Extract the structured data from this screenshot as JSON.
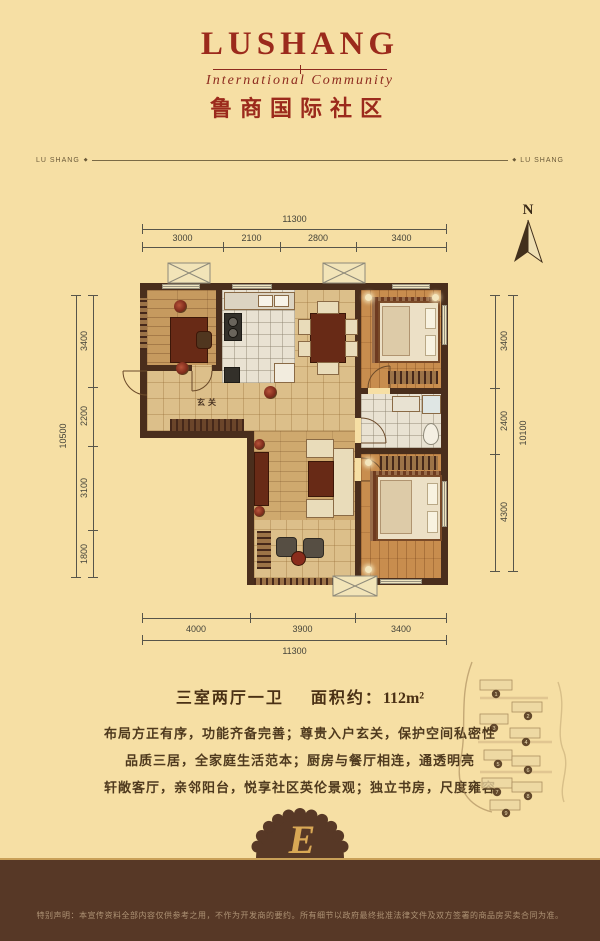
{
  "theme": {
    "background": "#f6dfa4",
    "brand_red": "#9b2a1c",
    "wall_brown": "#4a2e1c",
    "footer_brown": "#573826",
    "gold_line": "#c9a058",
    "badge_gold": "#d9a855",
    "dim_line": "#57554a"
  },
  "header": {
    "brand": "LUSHANG",
    "tagline": "International Community",
    "chinese_name": "鲁商国际社区",
    "ribbon_left": "LU SHANG",
    "ribbon_right": "LU SHANG",
    "ribbon_bullet": "◆"
  },
  "compass": {
    "label": "N"
  },
  "dims": {
    "top": {
      "total": "11300",
      "segs": [
        "3000",
        "2100",
        "2800",
        "3400"
      ]
    },
    "bottom": {
      "total": "11300",
      "segs": [
        "4000",
        "3900",
        "3400"
      ]
    },
    "left": {
      "total": "10500",
      "segs": [
        "3400",
        "2200",
        "3100",
        "1800"
      ]
    },
    "right": {
      "total": "10100",
      "segs": [
        "3400",
        "2400",
        "4300"
      ]
    }
  },
  "plan": {
    "entry_label": "玄关"
  },
  "info": {
    "rooms": "三室两厅一卫",
    "area_label": "面积约：",
    "area_value": "112m²",
    "desc": [
      "布局方正有序，功能齐备完善；尊贵入户玄关，保护空间私密性",
      "品质三居，全家庭生活范本；厨房与餐厅相连，通透明亮",
      "轩敞客厅，亲邻阳台，悦享社区英伦景观；独立书房，尺度雍容"
    ]
  },
  "sitemap": {
    "markers": [
      "1",
      "2",
      "3",
      "4",
      "5",
      "6",
      "7",
      "8",
      "9"
    ]
  },
  "badge": {
    "letter": "E"
  },
  "footer": {
    "disclaimer": "特别声明：本宣传资料全部内容仅供参考之用，不作为开发商的要约。所有细节以政府最终批准法律文件及双方签署的商品房买卖合同为准。"
  }
}
